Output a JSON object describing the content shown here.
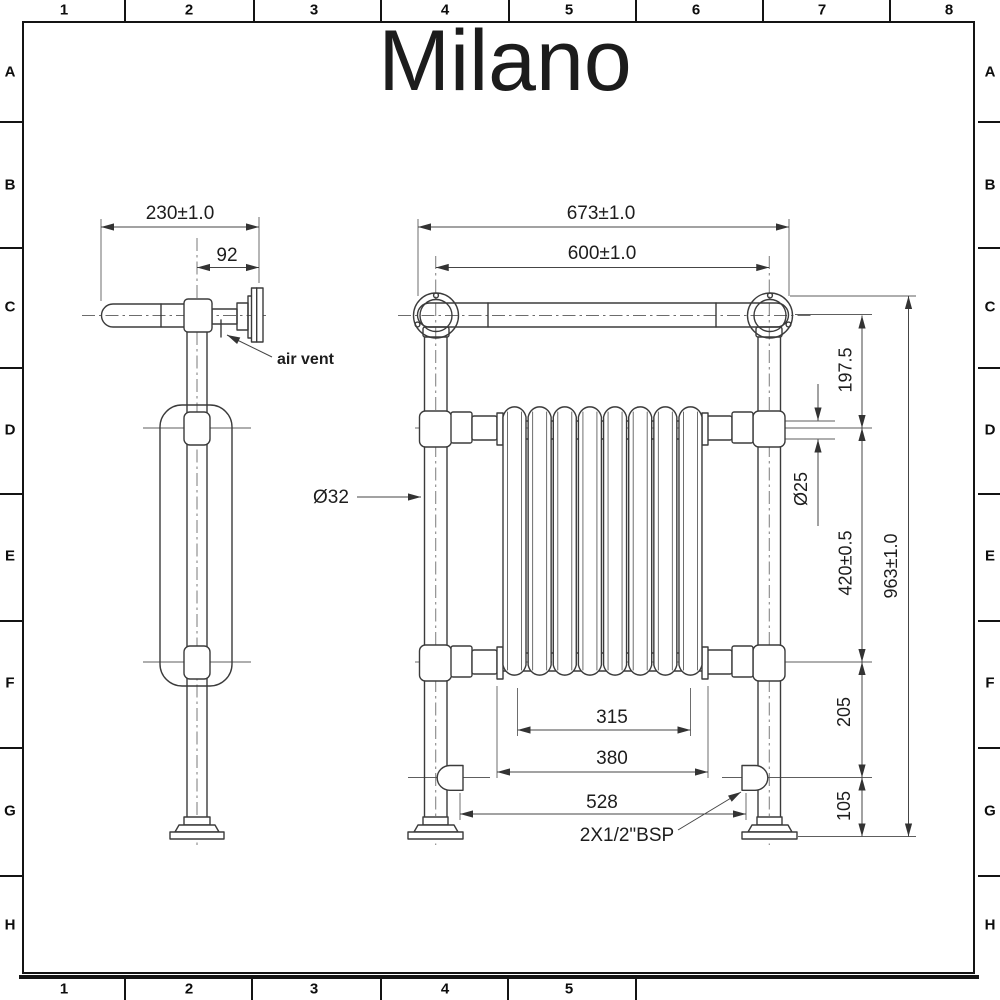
{
  "logo": {
    "text": "Milano"
  },
  "colors": {
    "ink": "#3b3b3b",
    "background": "#ffffff"
  },
  "grid": {
    "top_labels": [
      "1",
      "2",
      "3",
      "4",
      "5",
      "6",
      "7",
      "8"
    ],
    "bottom_labels": [
      "1",
      "2",
      "3",
      "4",
      "5"
    ],
    "left_labels": [
      "A",
      "B",
      "C",
      "D",
      "E",
      "F",
      "G",
      "H"
    ],
    "right_labels": [
      "A",
      "B",
      "C",
      "D",
      "E",
      "F",
      "G",
      "H"
    ]
  },
  "side_view": {
    "overall_depth": "230±1.0",
    "bracket_depth": "92",
    "air_vent": "air vent",
    "post_diameter": "Ø32"
  },
  "front_view": {
    "overall_width": "673±1.0",
    "centers_width": "600±1.0",
    "top_drop": "197.5",
    "crossbar_diameter": "Ø25",
    "crossbar_spacing": "420±0.5",
    "overall_height": "963±1.0",
    "core_inner_width": "315",
    "core_width": "380",
    "valve_centers": "528",
    "valve_drop": "205",
    "floor_clearance": "105",
    "connection": "2X1/2\"BSP"
  },
  "radiator": {
    "sections": 8
  }
}
